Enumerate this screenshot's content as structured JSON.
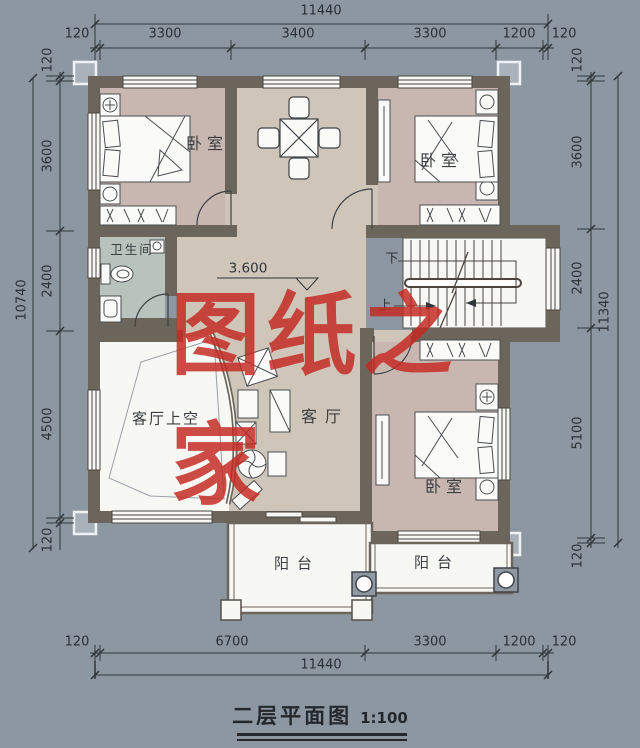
{
  "drawing": {
    "title": "二层平面图",
    "scale": "1:100",
    "watermark": "图纸之家",
    "level_marker": "3.600"
  },
  "rooms": {
    "bedroom_top_left": "卧室",
    "bedroom_top_right": "卧室",
    "bedroom_bottom_right": "卧室",
    "bathroom": "卫生间",
    "living_room": "客厅",
    "living_room_void": "客厅上空",
    "balcony_left": "阳台",
    "balcony_right": "阳台",
    "stairs_up": "上",
    "stairs_down": "下"
  },
  "dimensions": {
    "top": {
      "overall": "11440",
      "segments": [
        "120",
        "3300",
        "3400",
        "3300",
        "1200",
        "120"
      ]
    },
    "bottom": {
      "overall": "11440",
      "segments": [
        "120",
        "6700",
        "3300",
        "1200",
        "120"
      ]
    },
    "left": {
      "overall": "10740",
      "segments": [
        "120",
        "3600",
        "2400",
        "4500",
        "120"
      ]
    },
    "right": {
      "overall": "11340",
      "segments": [
        "120",
        "3600",
        "2400",
        "5100",
        "120"
      ]
    }
  },
  "colors": {
    "background": "#8C97A2",
    "wall": "#6B655B",
    "hall_floor": "#CFC6B9",
    "bedroom_floor": "#C8B7B0",
    "bathroom_floor": "#B7C3BC",
    "watermark_red": "#C52A22",
    "line": "#2F3439"
  }
}
